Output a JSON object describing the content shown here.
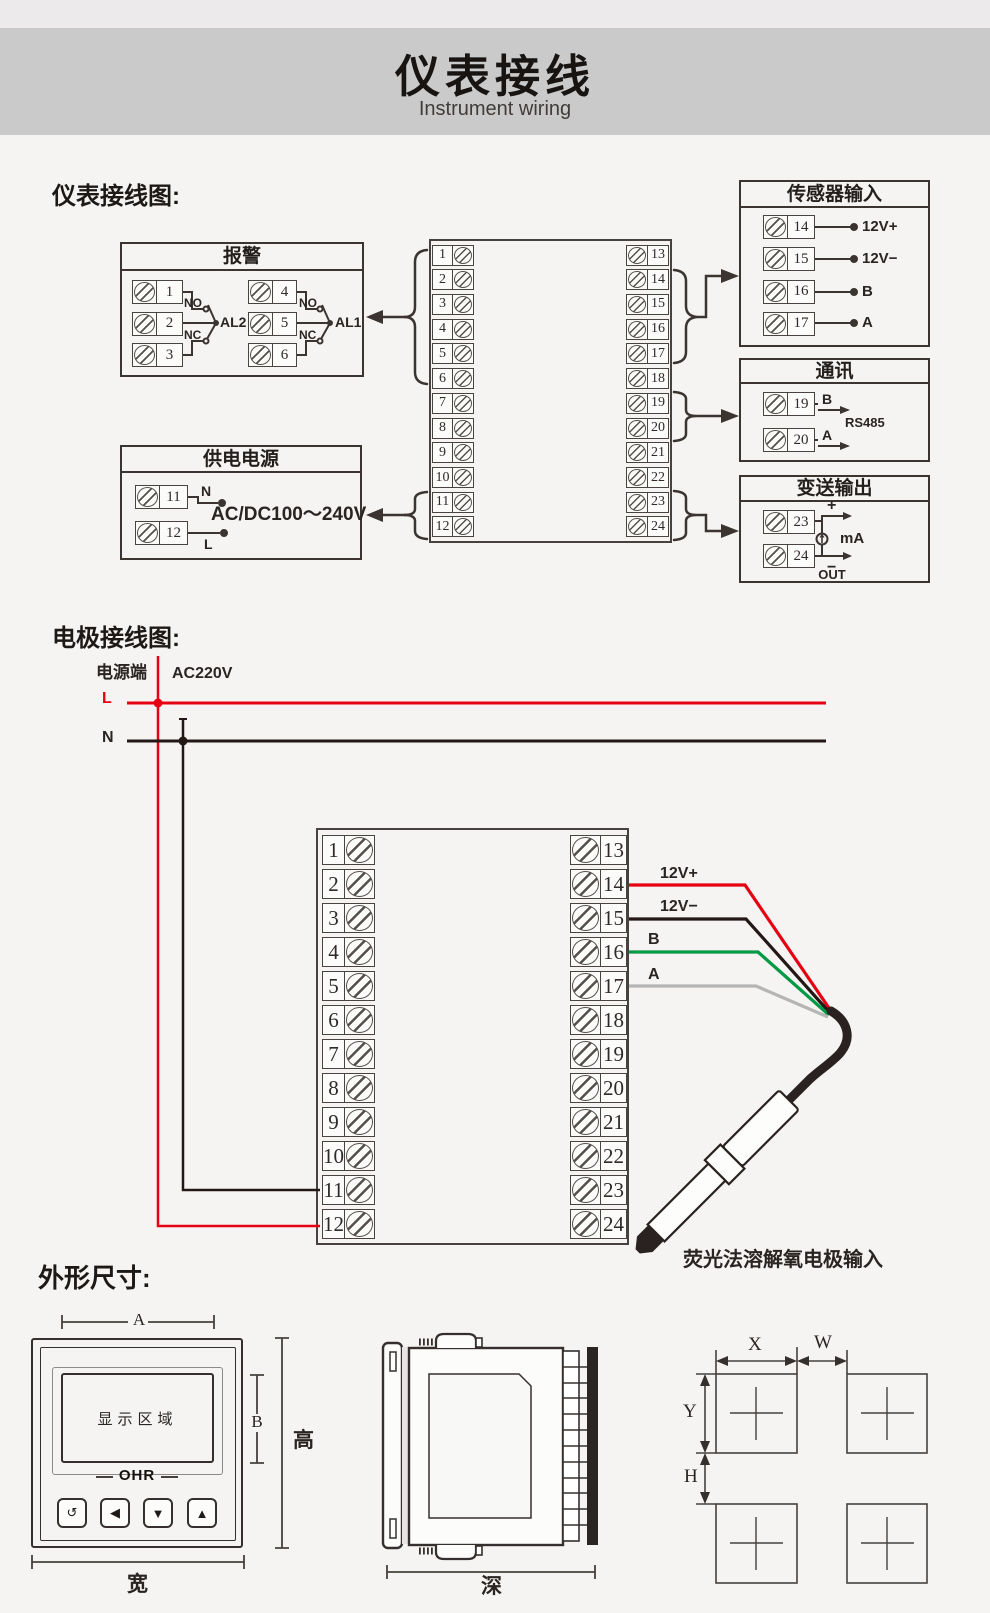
{
  "header": {
    "title": "仪表接线",
    "subtitle": "Instrument wiring"
  },
  "sections": {
    "wiring": "仪表接线图:",
    "electrode": "电极接线图:",
    "dimensions": "外形尺寸:"
  },
  "block": {
    "left": [
      "1",
      "2",
      "3",
      "4",
      "5",
      "6",
      "7",
      "8",
      "9",
      "10",
      "11",
      "12"
    ],
    "right": [
      "13",
      "14",
      "15",
      "16",
      "17",
      "18",
      "19",
      "20",
      "21",
      "22",
      "23",
      "24"
    ]
  },
  "alarm": {
    "title": "报警",
    "groups": [
      {
        "terminals": [
          "1",
          "2",
          "3"
        ],
        "no": "NO",
        "nc": "NC",
        "label": "AL2"
      },
      {
        "terminals": [
          "4",
          "5",
          "6"
        ],
        "no": "NO",
        "nc": "NC",
        "label": "AL1"
      }
    ]
  },
  "power": {
    "title": "供电电源",
    "terminals": [
      "11",
      "12"
    ],
    "neutral": "N",
    "live": "L",
    "voltage": "AC/DC100～240V"
  },
  "sensor": {
    "title": "传感器输入",
    "rows": [
      {
        "terminal": "14",
        "label": "12V+"
      },
      {
        "terminal": "15",
        "label": "12V−"
      },
      {
        "terminal": "16",
        "label": "B"
      },
      {
        "terminal": "17",
        "label": "A"
      }
    ]
  },
  "comm": {
    "title": "通讯",
    "rows": [
      {
        "terminal": "19",
        "label": "B"
      },
      {
        "terminal": "20",
        "label": "A"
      }
    ],
    "protocol": "RS485"
  },
  "output": {
    "title": "变送输出",
    "terminals": [
      "23",
      "24"
    ],
    "plus": "+",
    "minus": "−",
    "unit": "mA",
    "out": "OUT"
  },
  "electrode": {
    "source_label": "电源端",
    "voltage": "AC220V",
    "live": "L",
    "neutral": "N",
    "wires": [
      {
        "terminal": "14",
        "label": "12V+",
        "color": "#e60012"
      },
      {
        "terminal": "15",
        "label": "12V−",
        "color": "#231815"
      },
      {
        "terminal": "16",
        "label": "B",
        "color": "#009944"
      },
      {
        "terminal": "17",
        "label": "A",
        "color": "#b5b5b6"
      }
    ],
    "caption": "荧光法溶解氧电极输入"
  },
  "dimensions": {
    "front": {
      "a": "A",
      "b": "B",
      "height": "高",
      "width": "宽",
      "display_area": "显示区域",
      "logo": "OHR",
      "buttons": [
        "↺",
        "◀",
        "▼",
        "▲"
      ]
    },
    "side": {
      "depth": "深"
    },
    "cutout": {
      "x": "X",
      "w": "W",
      "y": "Y",
      "h": "H"
    }
  },
  "colors": {
    "live_red": "#e60012",
    "neutral_black": "#231815",
    "wire_green": "#009944",
    "wire_gray": "#b5b5b6"
  }
}
